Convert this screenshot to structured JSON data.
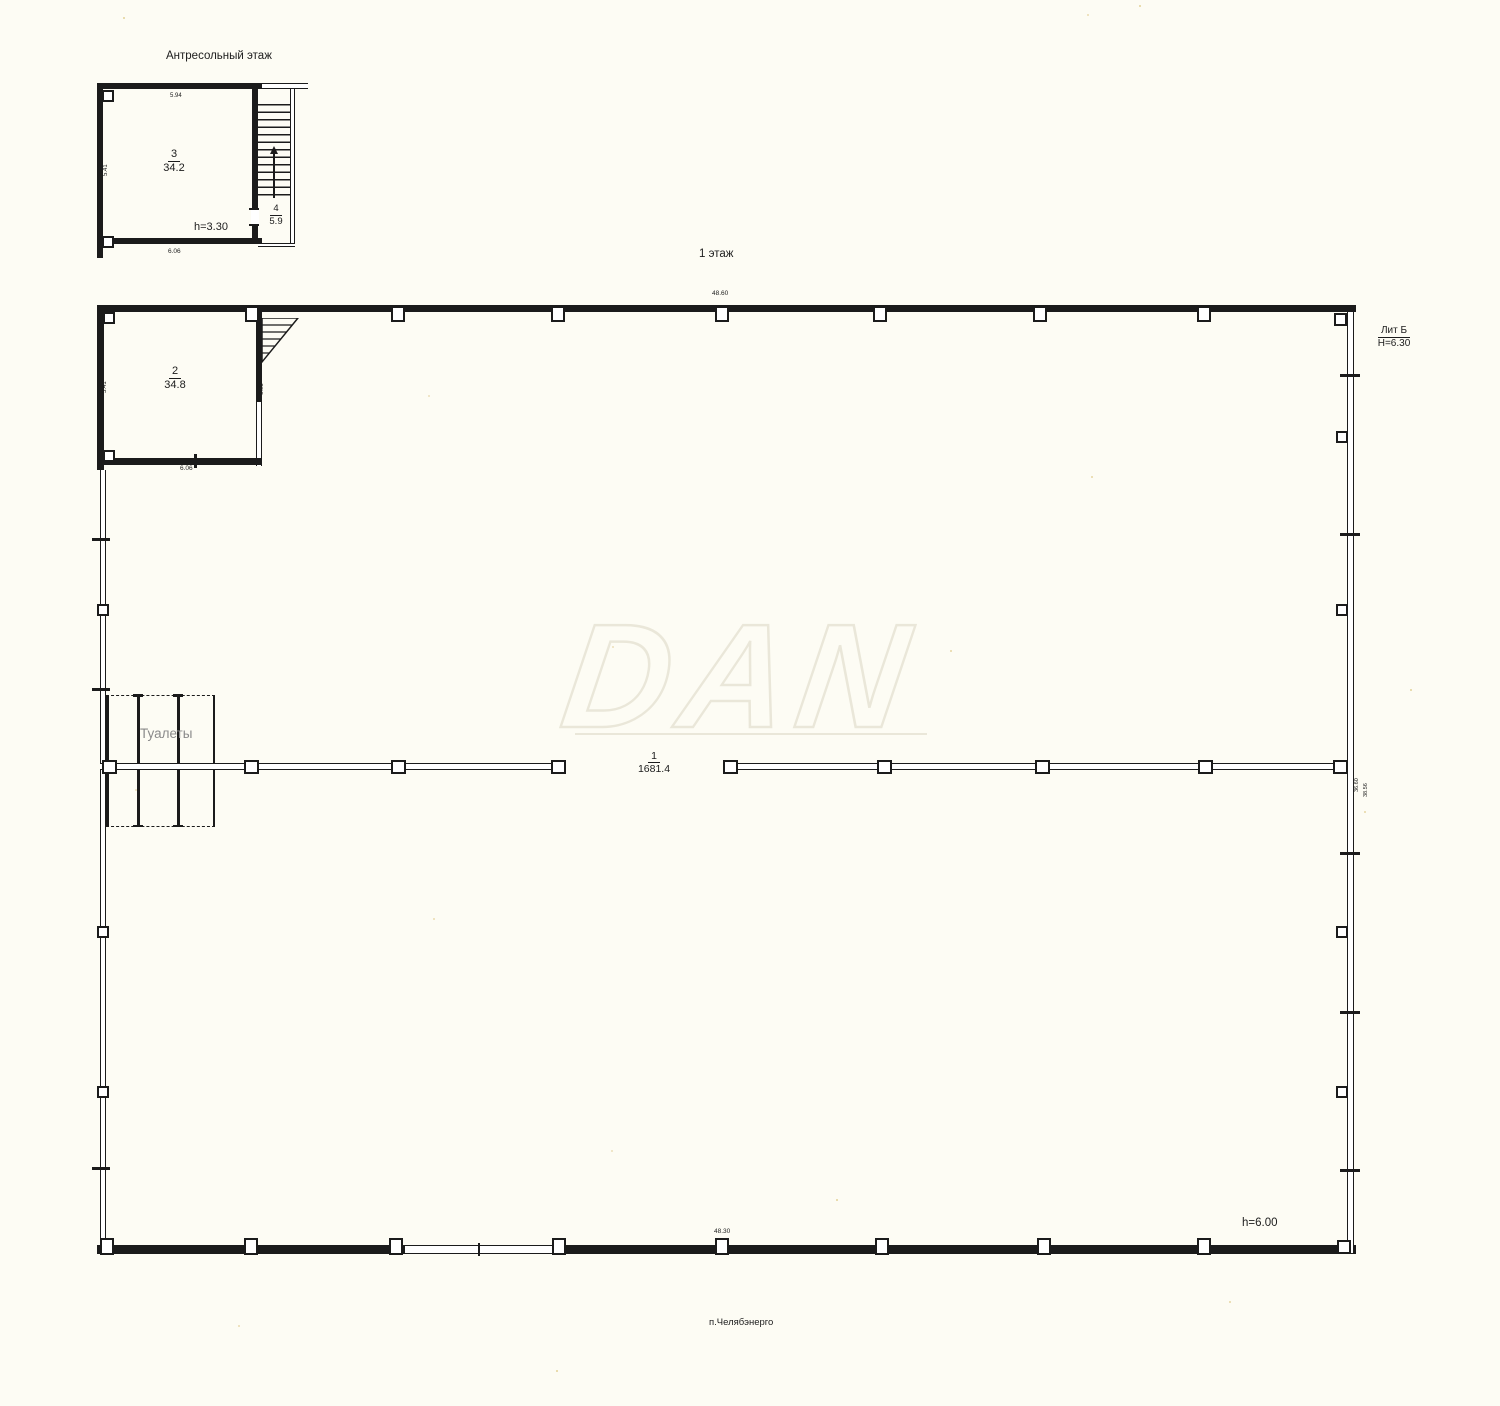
{
  "colors": {
    "paper": "#fdfcf4",
    "ink": "#1c1c1c",
    "toilets_gray": "#8a8a8a",
    "watermark": "#eae7d9"
  },
  "watermark": {
    "text": "DAN"
  },
  "mezzanine": {
    "title": "Антресольный этаж",
    "room3": {
      "number": "3",
      "area": "34.2"
    },
    "room4": {
      "number": "4",
      "area": "5.9"
    },
    "height": "h=3.30",
    "dims": {
      "top": "5.94",
      "left": "5.41",
      "bottom": "6.06"
    }
  },
  "floor1": {
    "title": "1 этаж",
    "liter": {
      "name": "Лит Б",
      "height": "H=6.30"
    },
    "hall": {
      "number": "1",
      "area": "1681.4"
    },
    "room2": {
      "number": "2",
      "area": "34.8",
      "dims": {
        "top": "5.94",
        "left": "5.41",
        "bottom": "6.06",
        "right": "6.05"
      }
    },
    "toilets": "Туалеты",
    "dims": {
      "top": "48.60",
      "bottom": "48.30",
      "right_inner": "36.60",
      "right_outer": "38.56"
    },
    "height": "h=6.00",
    "address": "п.Челябэнерго"
  }
}
